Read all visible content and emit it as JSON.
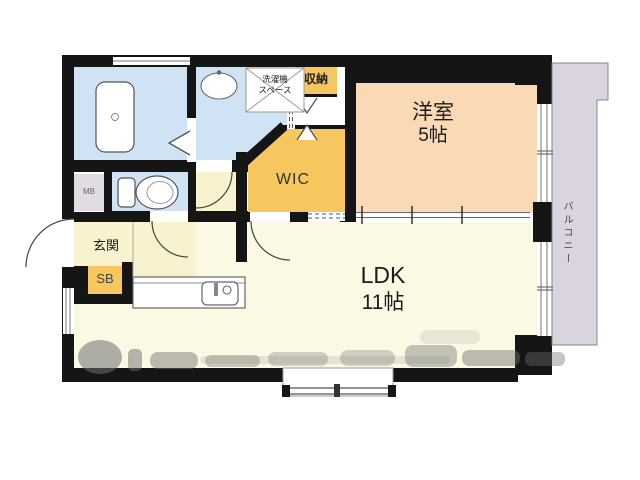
{
  "plan_title": "apartment-floor-plan",
  "rooms": {
    "western": {
      "name": "洋室",
      "size": "5帖"
    },
    "ldk": {
      "name": "LDK",
      "size": "11帖"
    },
    "wic": {
      "name": "WIC"
    },
    "storage": {
      "name": "収納"
    },
    "laundry": {
      "line1": "洗濯機",
      "line2": "スペース"
    },
    "entrance": {
      "name": "玄関"
    },
    "shoebox": {
      "name": "SB"
    },
    "meterbox": {
      "name": "MB"
    },
    "balcony": {
      "name": "バルコニー"
    }
  },
  "colors": {
    "wall": "#151515",
    "water_blue": "#cfe3f4",
    "peach": "#f9d9b6",
    "closet_yellow": "#f6c75f",
    "ldk_cream": "#fbf8e4",
    "hall_cream": "#f8f2cf",
    "balcony_gray": "#d9d4df",
    "mb_gray": "#e0dce1",
    "line_gray": "#777777"
  }
}
